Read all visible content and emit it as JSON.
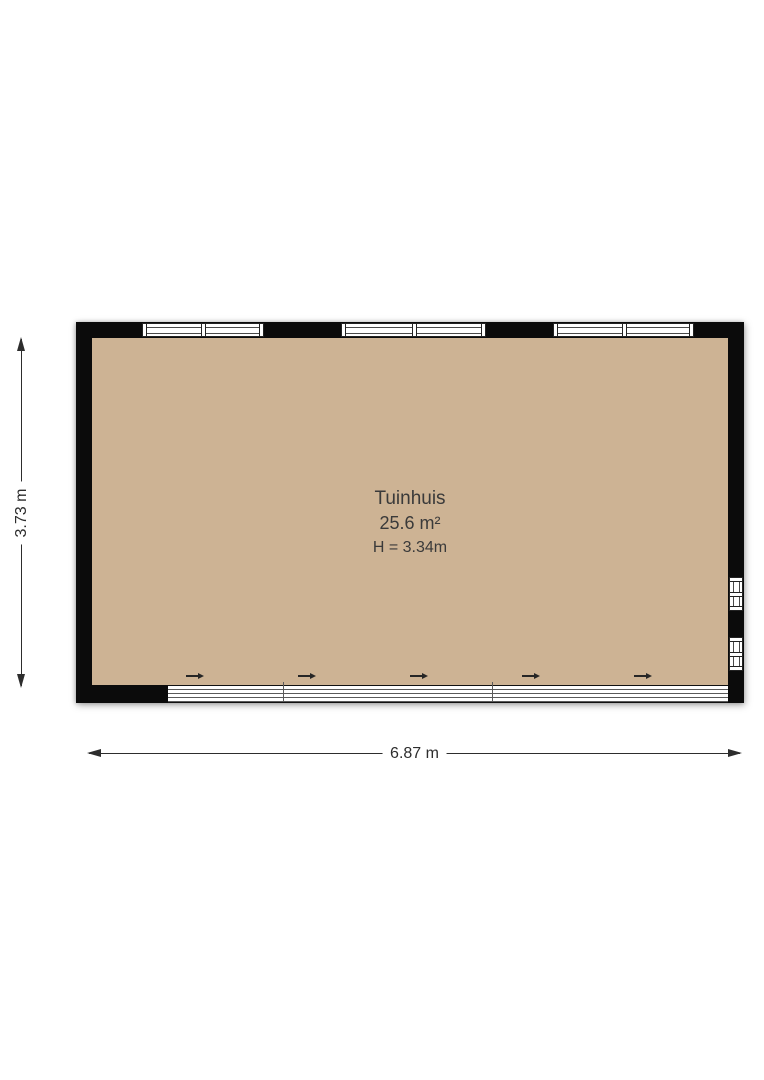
{
  "room": {
    "name": "Tuinhuis",
    "area": "25.6 m²",
    "ceiling_height": "H = 3.34m"
  },
  "dimensions": {
    "width_label": "6.87 m",
    "height_label": "3.73 m"
  },
  "icons": {
    "slide_direction_arrow": "→"
  },
  "colors": {
    "floor": "#cdb394",
    "wall": "#0b0b0b",
    "window_fill": "#ffffff",
    "line": "#222222",
    "text": "#3a3a3a"
  }
}
